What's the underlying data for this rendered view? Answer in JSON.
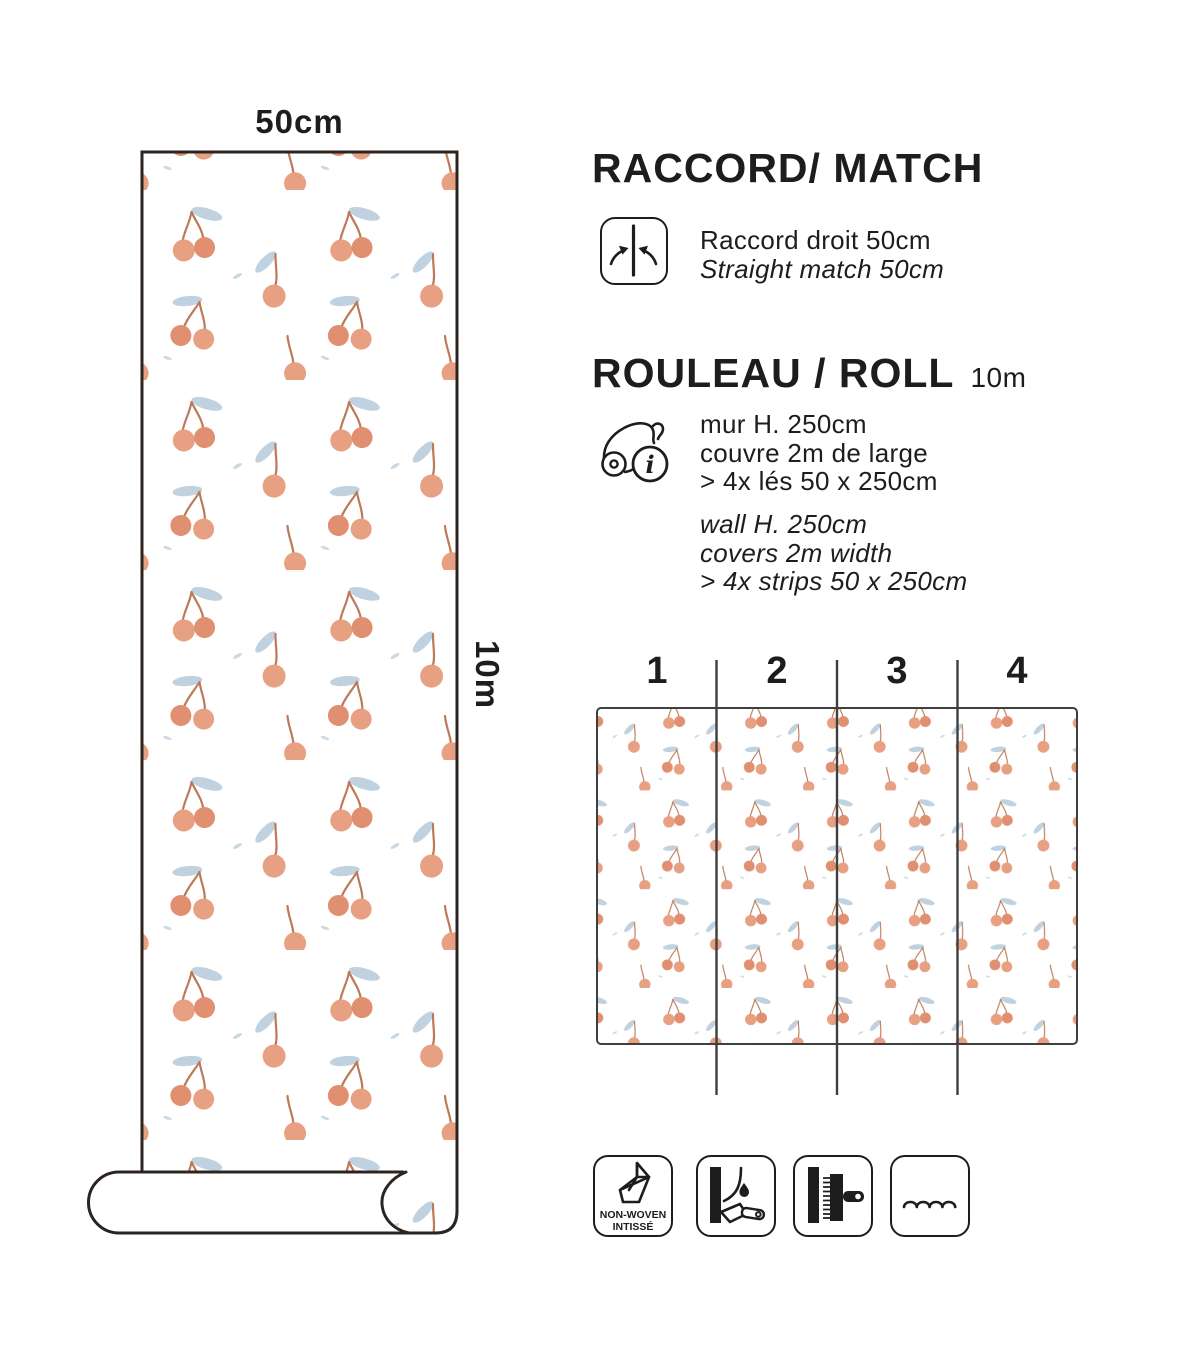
{
  "colors": {
    "ink": "#1d1d1b",
    "outline": "#2b2420",
    "divider": "#3f3f3f",
    "cherry": "#e8a083",
    "cherry2": "#e09070",
    "stem": "#bc7a58",
    "leaf": "#c0d2e0"
  },
  "roll_preview": {
    "width_label": "50cm",
    "length_label": "10m"
  },
  "match_section": {
    "title": "RACCORD/ MATCH",
    "fr": "Raccord droit 50cm",
    "en": "Straight match 50cm"
  },
  "roll_section": {
    "title": "ROULEAU / ROLL",
    "length": "10m",
    "fr_lines": [
      "mur H. 250cm",
      "couvre 2m de large",
      "> 4x lés 50 x 250cm"
    ],
    "en_lines": [
      "wall H. 250cm",
      "covers 2m width",
      "> 4x strips 50 x 250cm"
    ]
  },
  "strips_diagram": {
    "numbers": [
      "1",
      "2",
      "3",
      "4"
    ]
  },
  "features": {
    "non_woven": {
      "line1": "NON-WOVEN",
      "line2": "INTISSÉ"
    }
  }
}
